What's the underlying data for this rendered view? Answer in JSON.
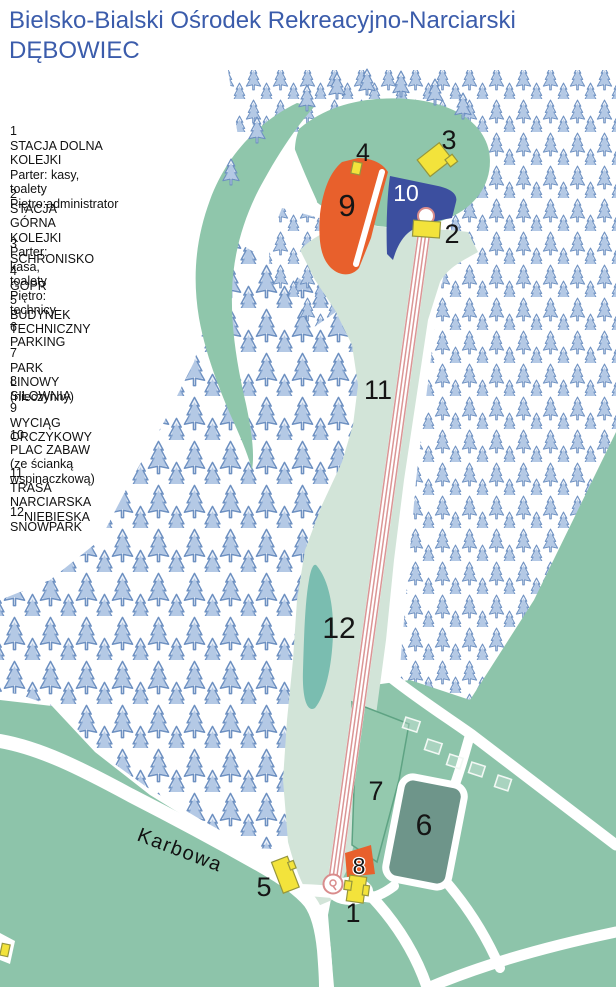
{
  "title": {
    "line1": "Bielsko-Bialski Ośrodek Rekreacyjno-Narciarski",
    "line2": "DĘBOWIEC"
  },
  "legend": [
    {
      "num": "1",
      "lines": [
        "STACJA DOLNA KOLEJKI",
        "Parter: kasy, toalety",
        "Piętro:administrator"
      ]
    },
    {
      "num": "2",
      "lines": [
        "STACJA GÓRNA KOLEJKI",
        "Parter: kasa, toalety",
        "Piętro: technicy"
      ]
    },
    {
      "num": "3",
      "lines": [
        "SCHRONISKO"
      ]
    },
    {
      "num": "4",
      "lines": [
        "GOPR"
      ]
    },
    {
      "num": "5",
      "lines": [
        "BUDYNEK TECHNICZNY"
      ]
    },
    {
      "num": "6",
      "lines": [
        "PARKING"
      ]
    },
    {
      "num": "7",
      "lines": [
        "PARK LINOWY (nieczynny)"
      ]
    },
    {
      "num": "8",
      "lines": [
        "SIŁOWNIA"
      ]
    },
    {
      "num": "9",
      "lines": [
        "WYCIĄG ORCZYKOWY"
      ]
    },
    {
      "num": "10",
      "lines": [
        "PLAC ZABAW (ze ścianką",
        "wspinaczkową)"
      ]
    },
    {
      "num": "11",
      "lines": [
        "TRASA NARCIARSKA",
        "NIEBIESKA"
      ]
    },
    {
      "num": "12",
      "lines": [
        "SNOWPARK"
      ]
    }
  ],
  "map": {
    "road_label": "Karbowa",
    "labels": {
      "m1": "1",
      "m2": "2",
      "m3": "3",
      "m4": "4",
      "m5": "5",
      "m6": "6",
      "m7": "7",
      "m8": "8",
      "m9": "9",
      "m10": "10",
      "m11": "11",
      "m12": "12"
    }
  },
  "colors": {
    "title_blue": "#3b5cab",
    "clearing_green": "#8fc6ab",
    "meadow_green": "#8dc4aa",
    "zone7_green": "#94c9ae",
    "slope_green": "#d2e4d8",
    "pond_teal": "#7abdb0",
    "parking_gray": "#6e958a",
    "building_yellow": "#f3e33b",
    "building_outline": "#96963c",
    "lift_orange": "#e8602c",
    "playground_blue": "#3c4f9f",
    "lift_pink": "#db9595",
    "tree_blue": "#6d90c1",
    "road_white": "#ffffff",
    "zone7_outline": "#5ea383"
  }
}
